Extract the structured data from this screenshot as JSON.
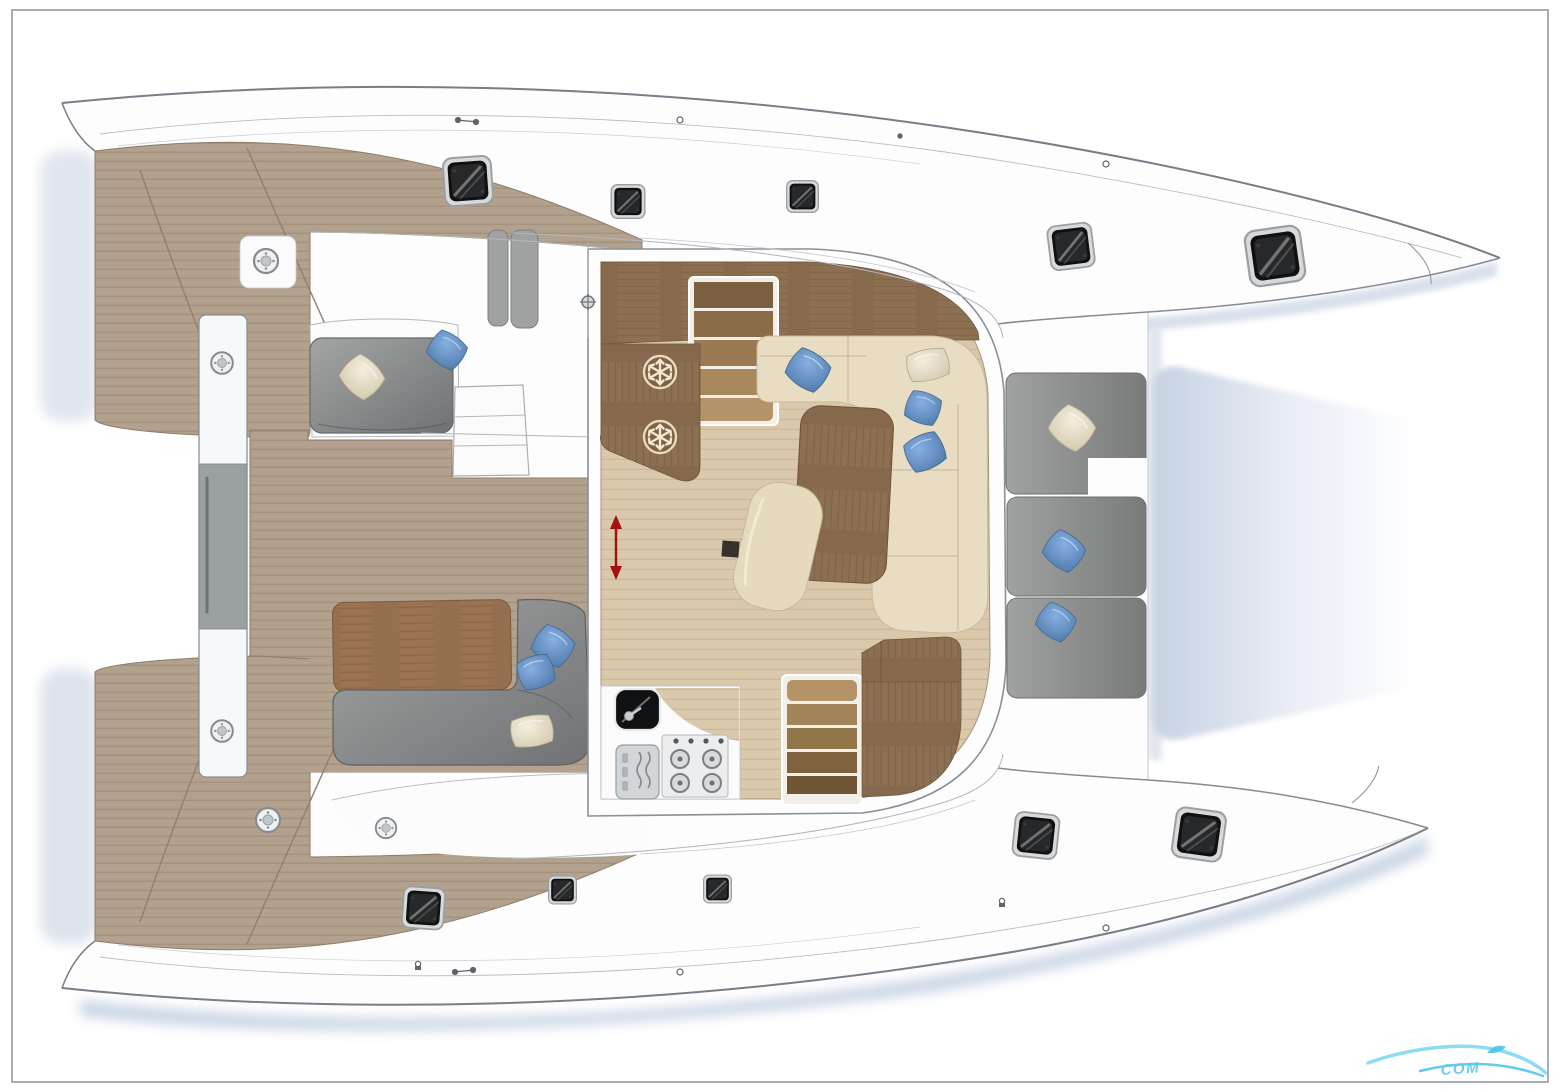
{
  "diagram": {
    "type": "boat-deck-plan",
    "subject": "catamaran floor plan top view",
    "watermark": {
      "text": "COM"
    }
  },
  "palette": {
    "hull_white": "#fdfdfe",
    "outline_gray": "#7d838c",
    "teak_deck": "#b2a18c",
    "interior_floor": "#dac8ab",
    "dark_wood": "#8d7052",
    "mid_wood": "#9b7351",
    "sofa_gray": "#8f9192",
    "cushion_cream": "#e8ddc3",
    "pillow_blue": "#6f9cd4",
    "pillow_white": "#efe9d8",
    "hatch_dark": "#141414",
    "arrow_red": "#a31111",
    "shadow_blue": "#b4c3da",
    "watermark_blue": "#5fc8ee"
  },
  "icons": [
    "snowflake-icon",
    "stove-burners-icon",
    "sink-icon",
    "microwave-icon",
    "deck-hatch-icon",
    "sliding-door-arrow-icon",
    "deck-fitting-icon",
    "mast-step-icon",
    "wave-logo-icon"
  ],
  "areas": [
    "aft-transom-steps",
    "cockpit-seating",
    "saloon",
    "galley",
    "companionway-stairs",
    "forward-cockpit-seats",
    "trampoline",
    "port-hull",
    "starboard-hull"
  ],
  "counts": {
    "deck_hatches": 10,
    "fridge_icons": 2,
    "pillows": 12
  }
}
